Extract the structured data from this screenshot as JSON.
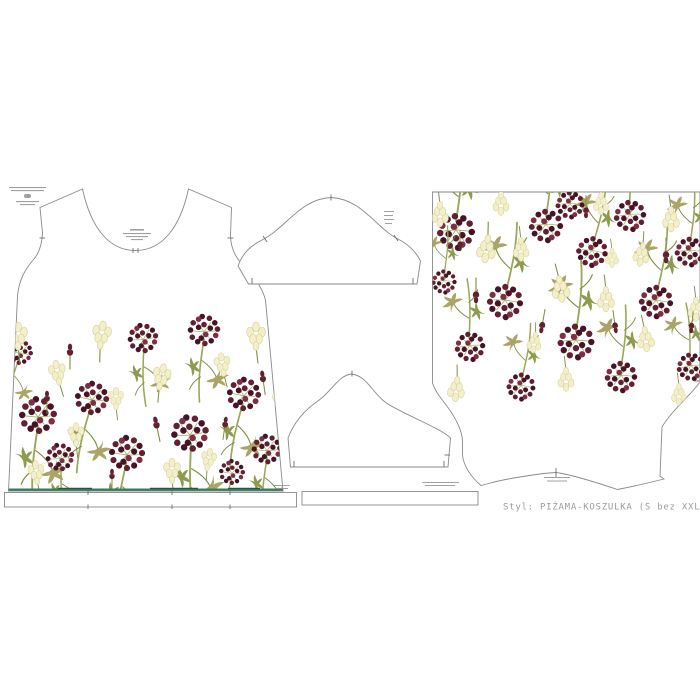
{
  "footer": {
    "style_label": "Styl: PIŻAMA-KOSZULKA (S bez XXL"
  },
  "colors": {
    "outline": "#8a8a8a",
    "tick": "#707070",
    "berry_dark": "#471325",
    "berry_mid": "#622031",
    "berry_light": "#7d3044",
    "stem": "#9aa757",
    "stem_dark": "#7f8d45",
    "leaf_a": "#aaa566",
    "leaf_b": "#8f9a4e",
    "cream": "#f2efc9",
    "cream_stroke": "#d6cf9a",
    "hemline": "#3a7a5f",
    "hemline_dark": "#245842",
    "label": "#9b9b9b",
    "micro": "#8f8f8f"
  },
  "print_pattern": {
    "front": {
      "flip": false,
      "sprigs": [
        [
          38,
          415,
          1.05,
          0
        ],
        [
          92,
          398,
          0.95,
          8
        ],
        [
          143,
          338,
          0.85,
          -6
        ],
        [
          127,
          453,
          1,
          4
        ],
        [
          204,
          330,
          0.9,
          0
        ],
        [
          190,
          433,
          1.05,
          -6
        ],
        [
          244,
          394,
          0.95,
          7
        ],
        [
          267,
          449,
          0.85,
          0
        ],
        [
          60,
          457,
          0.8,
          -8
        ],
        [
          20,
          352,
          0.72,
          10
        ],
        [
          232,
          472,
          0.72,
          5
        ]
      ],
      "buds": [
        [
          18,
          333,
          1,
          0
        ],
        [
          57,
          370,
          0.9,
          -10
        ],
        [
          102,
          332,
          1,
          8
        ],
        [
          76,
          432,
          0.85,
          0
        ],
        [
          162,
          374,
          0.95,
          12
        ],
        [
          172,
          468,
          0.9,
          0
        ],
        [
          222,
          362,
          0.85,
          -8
        ],
        [
          256,
          333,
          1,
          0
        ],
        [
          281,
          398,
          0.9,
          6
        ],
        [
          116,
          396,
          0.8,
          0
        ],
        [
          36,
          470,
          0.85,
          -6
        ],
        [
          209,
          457,
          0.8,
          10
        ]
      ],
      "spikes": [
        [
          70,
          345,
          1,
          0
        ],
        [
          155,
          418,
          1,
          -12
        ],
        [
          226,
          418,
          0.9,
          8
        ],
        [
          47,
          392,
          0.9,
          0
        ],
        [
          262,
          372,
          0.95,
          -8
        ],
        [
          112,
          470,
          0.85,
          0
        ]
      ]
    },
    "back": {
      "flip": true,
      "sprigs": [
        [
          456,
          232,
          1.05,
          0
        ],
        [
          505,
          302,
          1,
          5
        ],
        [
          470,
          347,
          0.85,
          -6
        ],
        [
          546,
          226,
          0.95,
          0
        ],
        [
          592,
          252,
          0.88,
          8
        ],
        [
          576,
          342,
          1.02,
          0
        ],
        [
          630,
          216,
          0.9,
          -5
        ],
        [
          656,
          302,
          0.95,
          5
        ],
        [
          690,
          252,
          0.85,
          0
        ],
        [
          621,
          377,
          0.9,
          0
        ],
        [
          691,
          367,
          0.8,
          -8
        ],
        [
          521,
          387,
          0.8,
          5
        ],
        [
          444,
          282,
          0.7,
          0
        ],
        [
          570,
          205,
          0.8,
          0
        ]
      ],
      "buds": [
        [
          440,
          217,
          0.9,
          0
        ],
        [
          486,
          252,
          1,
          8
        ],
        [
          521,
          252,
          0.85,
          0
        ],
        [
          561,
          292,
          0.95,
          -8
        ],
        [
          606,
          302,
          0.9,
          0
        ],
        [
          641,
          257,
          0.85,
          10
        ],
        [
          671,
          222,
          0.9,
          0
        ],
        [
          696,
          312,
          0.85,
          0
        ],
        [
          456,
          392,
          0.9,
          6
        ],
        [
          566,
          382,
          0.85,
          0
        ],
        [
          646,
          342,
          0.9,
          -6
        ],
        [
          601,
          206,
          0.8,
          0
        ],
        [
          501,
          206,
          0.85,
          0
        ],
        [
          679,
          397,
          0.8,
          0
        ],
        [
          534,
          345,
          0.75,
          8
        ],
        [
          612,
          260,
          0.7,
          0
        ]
      ],
      "spikes": [
        [
          476,
          302,
          1,
          0
        ],
        [
          541,
          332,
          0.95,
          10
        ],
        [
          616,
          332,
          0.9,
          -8
        ],
        [
          666,
          262,
          1,
          0
        ],
        [
          586,
          217,
          0.9,
          0
        ],
        [
          691,
          332,
          0.85,
          6
        ],
        [
          460,
          250,
          0.8,
          0
        ]
      ]
    }
  }
}
